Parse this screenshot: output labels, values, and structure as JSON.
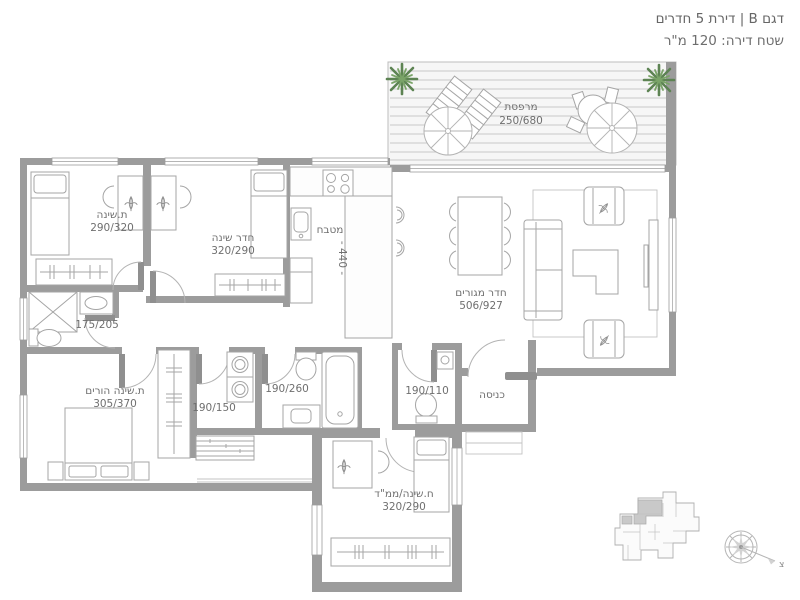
{
  "title": {
    "model_line": "דגם B | דירת 5 חדרים",
    "area_line": "שטח דירה: 120 מ\"ר"
  },
  "rooms": {
    "terrace": {
      "name": "מרפסת",
      "dims": "250/680"
    },
    "bedroom1": {
      "name": "ת.שינה",
      "dims": "290/320"
    },
    "bedroom2": {
      "name": "חדר שינה",
      "dims": "320/290"
    },
    "kitchen": {
      "name": "מטבח",
      "dims": "- 440 -"
    },
    "living_room": {
      "name": "חדר מגורים",
      "dims": "506/927"
    },
    "bathroom_small": {
      "dims": "175/205"
    },
    "parents_bedroom": {
      "name": "ת.שינה הורים",
      "dims": "305/370"
    },
    "laundry": {
      "dims": "190/150"
    },
    "bathroom_main": {
      "dims": "190/260"
    },
    "guest_toilet": {
      "dims": "190/110"
    },
    "entrance": {
      "name": "כניסה"
    },
    "safe_room": {
      "name": "ח.שינה/ממ\"ד",
      "dims": "320/290"
    }
  },
  "compass": {
    "north_label": "צ"
  },
  "colors": {
    "wall": "#9c9c9c",
    "furniture_line": "#a5a5a5",
    "label_text": "#6f6f6f",
    "plant_green": "#5d8353",
    "deck_stripe": "#d1d1d1",
    "keyplan_highlight": "#c9c9c9"
  }
}
